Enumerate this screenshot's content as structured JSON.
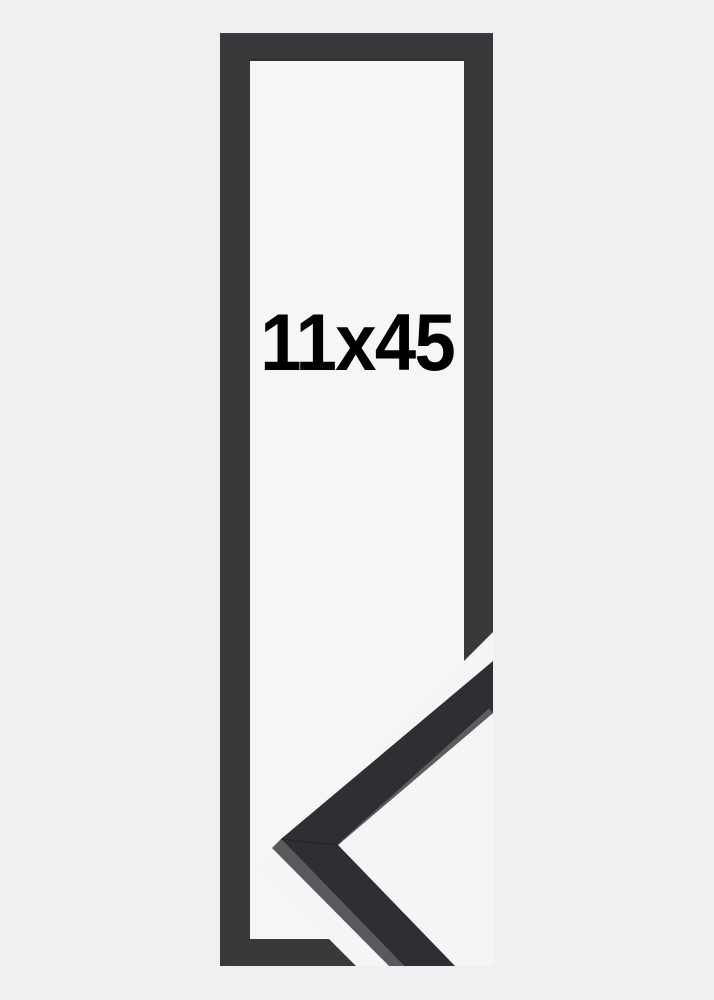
{
  "product": {
    "size_label": "11x45"
  },
  "image": {
    "description": "Black narrow picture frame product photo with magnified corner profile detail at bottom right",
    "background_color": "#f0f0f2",
    "frame_inner_background_color": "#f6f6f7",
    "frame_color": "#38393b",
    "frame_inner_shadow_color": "#2c2d2f",
    "frame_top_bevel_color": "#47484c",
    "gap_color": "#f5f5f6",
    "corner_face_color": "#2e2f32",
    "corner_side_color": "#57595d",
    "corner_edge_highlight_color": "#63656a",
    "seam_color": "#1c1d1f",
    "label_color": "#000000"
  }
}
